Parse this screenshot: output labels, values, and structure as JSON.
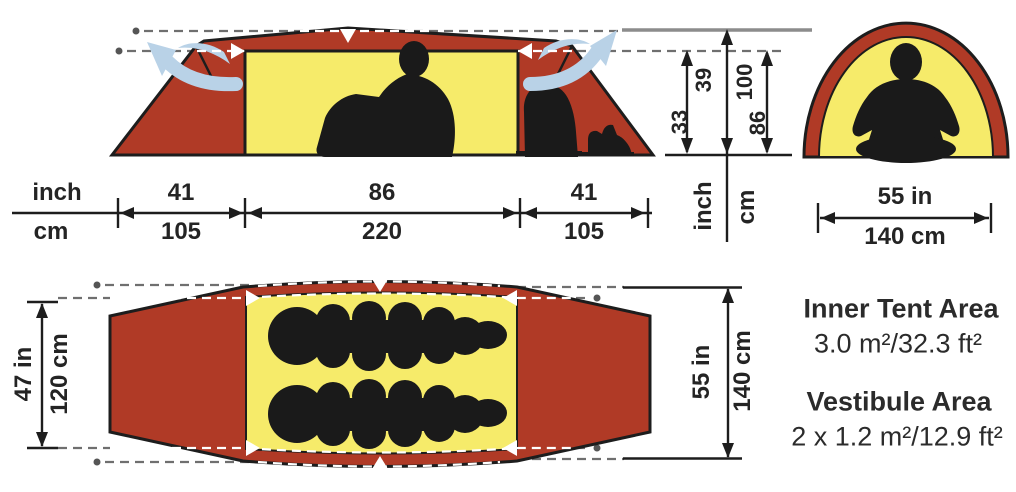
{
  "side_view": {
    "scale": {
      "unit_top": "inch",
      "unit_bottom": "cm"
    },
    "widths_in": [
      "41",
      "86",
      "41"
    ],
    "widths_cm": [
      "105",
      "220",
      "105"
    ],
    "heights": {
      "inner_in": "33",
      "peak_in": "39",
      "peak_cm": "100",
      "inner_cm": "86",
      "unit_in": "inch",
      "unit_cm": "cm"
    }
  },
  "end_view": {
    "width_in": "55 in",
    "width_cm": "140 cm"
  },
  "top_view": {
    "inner_width_in": "47 in",
    "inner_width_cm": "120 cm",
    "outer_width_in": "55 in",
    "outer_width_cm": "140 cm"
  },
  "areas": {
    "inner_label": "Inner Tent Area",
    "inner_value": "3.0 m²/32.3 ft²",
    "vestibule_label": "Vestibule Area",
    "vestibule_value": "2 x 1.2 m²/12.9 ft²"
  },
  "colors": {
    "fly_red": "#b03a26",
    "inner_yellow": "#f6eb6a",
    "vent_blue": "#b9d2e7",
    "silhouette": "#1a1a1a",
    "dash_gray": "#6f6f6f",
    "line_black": "#1d1d1d",
    "ref_gray": "#8c8c8c",
    "marker_white": "#ffffff",
    "text": "#242424"
  }
}
